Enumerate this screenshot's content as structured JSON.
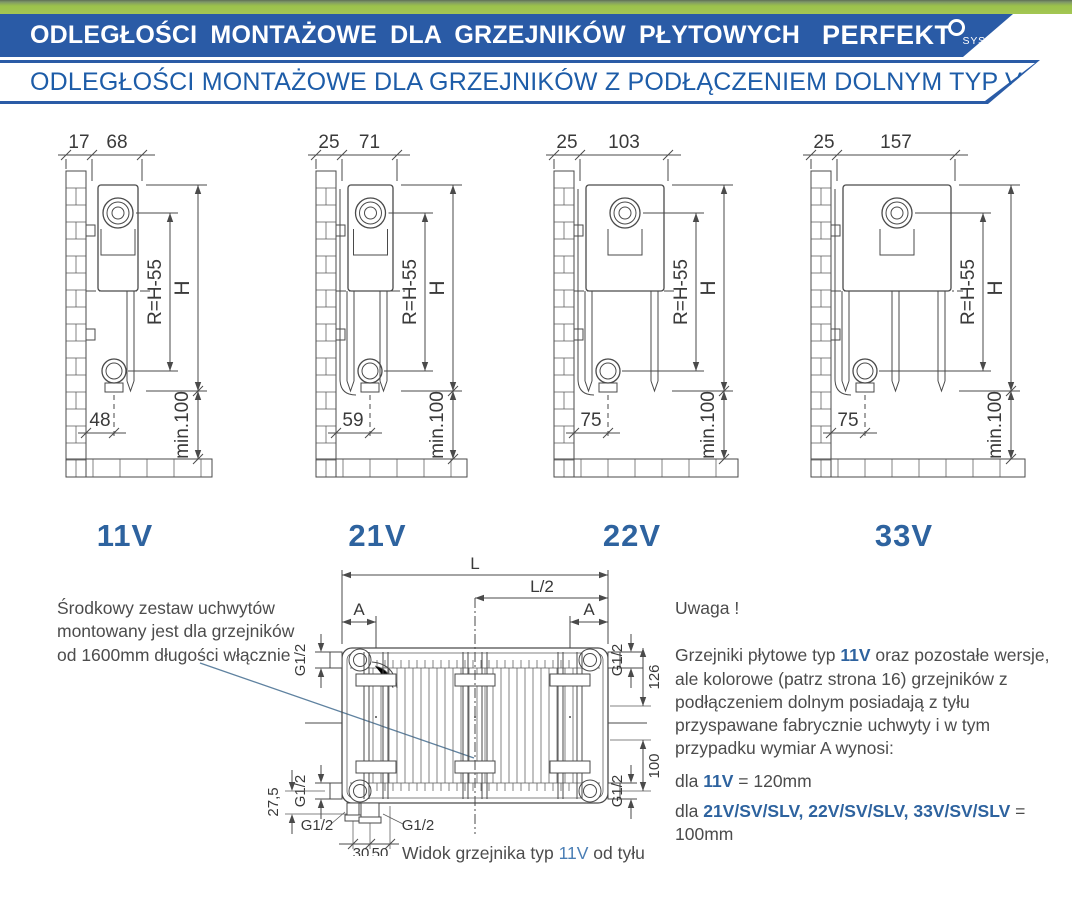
{
  "header": {
    "banner1": {
      "title": "ODLEGŁOŚCI MONTAŻOWE DLA GRZEJNIKÓW PŁYTOWYCH",
      "logo_text": "PERFEKT",
      "logo_sub": "SYSTEM"
    },
    "banner2": {
      "title": "ODLEGŁOŚCI MONTAŻOWE DLA GRZEJNIKÓW Z PODŁĄCZENIEM DOLNYM TYP V ,SV ,SLV"
    }
  },
  "colors": {
    "banner_blue": "#2a5ba6",
    "accent_blue": "#2e639f",
    "green": "#9cc24b",
    "line_gray": "#4a4a4a",
    "leader_blue": "#5f82a0"
  },
  "diagrams": [
    {
      "type_label": "11V",
      "dim_wall_gap": "17",
      "dim_depth": "68",
      "dim_bottom": "48",
      "dim_radius": "R=H-55",
      "dim_height": "H",
      "dim_min": "min.100"
    },
    {
      "type_label": "21V",
      "dim_wall_gap": "25",
      "dim_depth": "71",
      "dim_bottom": "59",
      "dim_radius": "R=H-55",
      "dim_height": "H",
      "dim_min": "min.100"
    },
    {
      "type_label": "22V",
      "dim_wall_gap": "25",
      "dim_depth": "103",
      "dim_bottom": "75",
      "dim_radius": "R=H-55",
      "dim_height": "H",
      "dim_min": "min.100"
    },
    {
      "type_label": "33V",
      "dim_wall_gap": "25",
      "dim_depth": "157",
      "dim_bottom": "75",
      "dim_radius": "R=H-55",
      "dim_height": "H",
      "dim_min": "min.100"
    }
  ],
  "left_note": {
    "lines": [
      "Środkowy zestaw uchwytów",
      "montowany jest dla grzejników",
      "od 1600mm długości włącznie"
    ]
  },
  "rear": {
    "dim_L": "L",
    "dim_L2": "L/2",
    "dim_A_left": "A",
    "dim_A_right": "A",
    "g12_top_left": "G1/2",
    "g12_top_right": "G1/2",
    "g12_bottom_left": "G1/2",
    "g12_bottom_right": "G1/2",
    "g12_stub_left": "G1/2",
    "g12_stub_right": "G1/2",
    "dim_126": "126",
    "dim_100": "100",
    "dim_275": "27,5",
    "dim_30": "30",
    "dim_50": "50"
  },
  "caption": {
    "parts": [
      "Widok grzejnika typ ",
      "11V",
      " od tyłu"
    ]
  },
  "uwaga": {
    "title": "Uwaga !",
    "para": [
      "Grzejniki płytowe typ ",
      "11V",
      " oraz pozostałe wersje, ale kolorowe (patrz strona 16) grzejników z podłączeniem dolnym posiadają z tyłu przyspawane fabrycznie uchwyty i w tym przypadku wymiar A wynosi:"
    ],
    "line_11v": [
      "dla ",
      "11V",
      " = 120mm"
    ],
    "line_others": [
      "dla ",
      "21V/SV/SLV, 22V/SV/SLV, 33V/SV/SLV",
      " = 100mm"
    ]
  }
}
